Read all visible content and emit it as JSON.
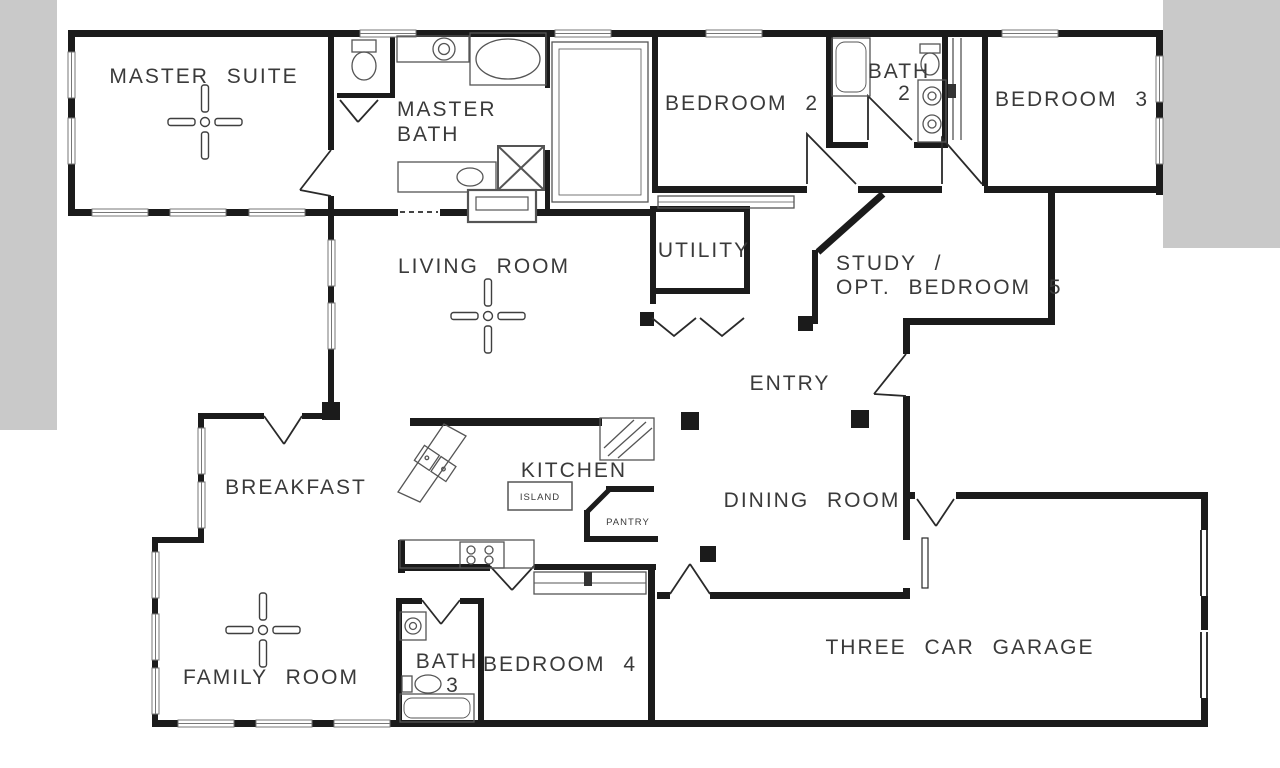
{
  "canvas": {
    "width": 1280,
    "height": 768,
    "background": "#ffffff",
    "matte_color": "#c9c9c9"
  },
  "floor_plan": {
    "type": "single-story house floor plan, black line drawing on white",
    "labels": {
      "master_suite": "MASTER SUITE",
      "master_bath_line1": "MASTER",
      "master_bath_line2": "BATH",
      "bedroom_2": "BEDROOM 2",
      "bath_2_line1": "BATH",
      "bath_2_line2": "2",
      "bedroom_3": "BEDROOM 3",
      "living_room": "LIVING ROOM",
      "utility": "UTILITY",
      "study_line1": "STUDY /",
      "study_line2": "OPT. BEDROOM 5",
      "entry": "ENTRY",
      "breakfast": "BREAKFAST",
      "kitchen": "KITCHEN",
      "island": "ISLAND",
      "pantry": "PANTRY",
      "dining_room": "DINING ROOM",
      "family_room": "FAMILY ROOM",
      "bath_3_line1": "BATH",
      "bath_3_line2": "3",
      "bedroom_4": "BEDROOM 4",
      "garage": "THREE CAR GARAGE"
    },
    "symbols": [
      {
        "name": "ceiling-fan-icon",
        "locations": [
          "master-suite",
          "living-room",
          "family-room"
        ]
      },
      {
        "name": "window-icon"
      },
      {
        "name": "door-swing-icon"
      },
      {
        "name": "bifold-door-icon",
        "location": "utility"
      },
      {
        "name": "toilet-icon",
        "locations": [
          "master-toilet-room",
          "bath-2",
          "bath-3"
        ]
      },
      {
        "name": "bathtub-icon",
        "locations": [
          "master-bath",
          "bath-2",
          "bath-3"
        ]
      },
      {
        "name": "sink-icon",
        "locations": [
          "master-bath",
          "bath-2",
          "bath-3",
          "kitchen"
        ]
      },
      {
        "name": "shower-icon",
        "location": "master-bath"
      },
      {
        "name": "stove-icon",
        "location": "kitchen"
      },
      {
        "name": "refrigerator-icon",
        "location": "kitchen"
      },
      {
        "name": "fireplace-icon",
        "location": "living-room"
      },
      {
        "name": "garage-door-icon",
        "location": "garage-right-wall"
      }
    ],
    "colors": {
      "wall": "#1b1b1b",
      "thin_line": "#666666",
      "label_text": "#3a3a3a"
    }
  }
}
